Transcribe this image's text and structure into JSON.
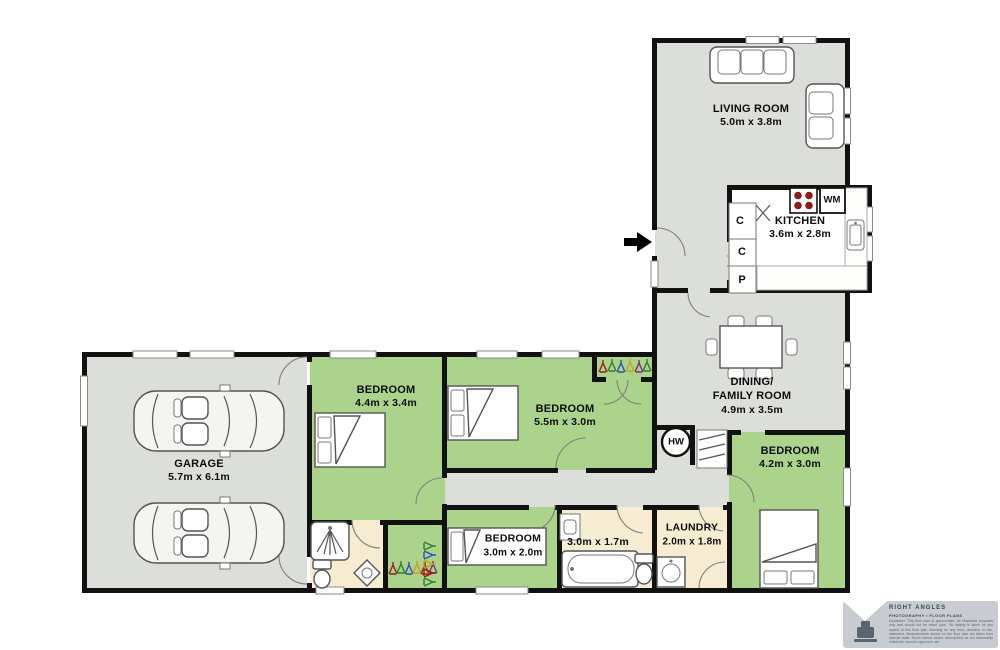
{
  "plan": {
    "colors": {
      "wall": "#111111",
      "floor_gray": "#dcded9",
      "floor_green": "#abd38c",
      "floor_cream": "#f6ecd2",
      "burner_red": "#8e1b1b",
      "footer_gray": "#c8ccd0",
      "hanger_palette": "#a01818 #2f7d2f #2c50b0 #caa020 #7d2a7d"
    },
    "rooms": {
      "living": {
        "name": "LIVING ROOM",
        "dims": "5.0m x 3.8m"
      },
      "kitchen": {
        "name": "KITCHEN",
        "dims": "3.6m x 2.8m"
      },
      "dining": {
        "name1": "DINING/",
        "name2": "FAMILY ROOM",
        "dims": "4.9m x 3.5m"
      },
      "bedroom_44": {
        "name": "BEDROOM",
        "dims": "4.4m x 3.4m"
      },
      "bedroom_55": {
        "name": "BEDROOM",
        "dims": "5.5m x 3.0m"
      },
      "bedroom_42": {
        "name": "BEDROOM",
        "dims": "4.2m x 3.0m"
      },
      "bedroom_30": {
        "name": "BEDROOM",
        "dims": "3.0m x 2.0m"
      },
      "bathroom": {
        "dims": "3.0m x 1.7m"
      },
      "laundry": {
        "name": "LAUNDRY",
        "dims": "2.0m x 1.8m"
      },
      "garage": {
        "name": "GARAGE",
        "dims": "5.7m x 6.1m"
      }
    },
    "fixtures": {
      "hot_water": "HW",
      "washing_machine": "WM",
      "cupboard_a": "C",
      "cupboard_b": "C",
      "pantry": "P"
    }
  },
  "footer": {
    "brand_line1": "RIGHT ANGLES",
    "brand_line2": "PHOTOGRAPHY • FLOOR PLANS",
    "disclaimer": "Disclaimer: This floor plan is approximate, for illustrative purposes only and should not be relied upon. No liability is taken for any aspect of this floor plan including for any error, omission or mis-statement. Measurements shown on the floor plan are taken from internal walls. Room names and/or descriptions do not necessarily reflect the council's approved use."
  }
}
